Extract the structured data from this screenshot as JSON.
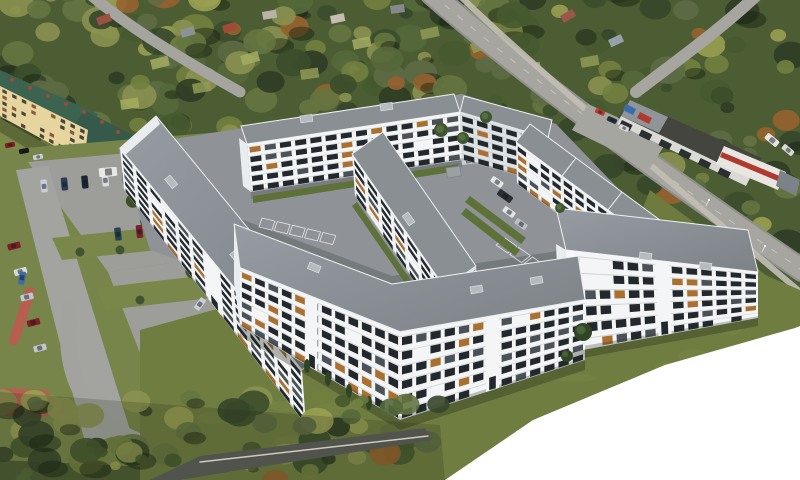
{
  "title": "Aerial 3D render of a new white residential apartment complex set into an aerial photograph",
  "visible_text": [],
  "colors": {
    "forest_base": "#4c5d33",
    "forest_palette": [
      "#3b4d2a",
      "#46592f",
      "#55683a",
      "#657540",
      "#72813f",
      "#5d6b44",
      "#8a9150",
      "#99a052",
      "#36462a",
      "#2e3c24"
    ],
    "forest_accent_rust": "#96622f",
    "lawn": "#6f7d40",
    "lawn_light": "#7b8a49",
    "left_grass": "#77854a",
    "road": "#a6a5a0",
    "road_edge": "#8f908c",
    "sidewalk": "#c2bfb4",
    "dark_road": "#51544c",
    "curb": "#cfcabd",
    "parking_asphalt": "#9d9e9a",
    "courtyard_asphalt": "#8f9398",
    "marking": "#ffffff",
    "facade": "#f3f5f6",
    "facade_shade": "#dde2e5",
    "gable": "#e9edef",
    "roof_gray": "#8a8f94",
    "roof_light": "#9aa0a6",
    "roof_dark": "#7e8388",
    "parapet": "#eef1f3",
    "window_dark": "#23282d",
    "window_light": "#4a5258",
    "wood_accent": "#a9702f",
    "green_roof": "#3c6350",
    "green_roof_dark": "#35594a",
    "yellow_facade": "#e7d5a0",
    "orange_facade": "#c8924e",
    "orange_roof": "#7a4434",
    "chimney_red": "#a14b36",
    "hedge": "#4d6330",
    "hedge_dark": "#3c5026",
    "tree_green": "#3f5531",
    "tree_dark": "#2f4526",
    "shed_roof": "#6b4a33",
    "red_path": "#b65f4e",
    "warehouse_roof": "#45453f",
    "warehouse_light": "#90959a",
    "retail_white": "#e8e6e0",
    "retail_red": "#b03a30",
    "sign_blue": "#3a6ea8",
    "container_gray": "#9aa0a4",
    "white_crop": "#ffffff",
    "shadow": "rgba(30,38,24,0.32)"
  },
  "scene": {
    "setting": "daytime aerial view, new housing estate render over photo background",
    "render_buildings": [
      {
        "id": "west-building",
        "floors": 6,
        "style": "long white slab, flat gray roof, balconies, wood accents"
      },
      {
        "id": "north-building",
        "floors": 5,
        "style": "long bent white slab at top of courtyard"
      },
      {
        "id": "center-building",
        "floors": 5,
        "style": "mid-block slab running toward viewer"
      },
      {
        "id": "east-buildings",
        "floors": 5,
        "blocks": 3,
        "style": "stepped row along the road"
      },
      {
        "id": "front-building",
        "floors": 6,
        "shape": "L",
        "style": "largest foreground building with corner"
      },
      {
        "id": "southeast-building",
        "floors": 6,
        "style": "detached slab on the lawn, white corner pilaster"
      }
    ],
    "photo_elements": [
      {
        "id": "existing-building",
        "roof": "green",
        "facade": "yellow",
        "chimneys": "red brick"
      },
      {
        "id": "orange-building",
        "position": "left edge"
      },
      {
        "id": "commercial-warehouse",
        "roof": "dark mottled"
      },
      {
        "id": "retail-building",
        "accent": "red stripe"
      },
      {
        "id": "allotment-gardens",
        "position": "top band"
      },
      {
        "id": "waste-shed",
        "roof": "brown"
      }
    ],
    "environment": {
      "tree_canopy": "dense mixed green/olive canopy across top and bottom-left",
      "main_road": "diagonal from top center to right edge",
      "parking": "two photo lots full of cars on the left, render stalls in courtyard",
      "lawn": "large olive lawn in front of render buildings",
      "white_corner": "render cut-off, pure white wedge at bottom right"
    }
  },
  "vehicles": {
    "car_colors": [
      "#7e1f26",
      "#1d2734",
      "#d9dbdd",
      "#151a1f",
      "#82222c",
      "#2a3d55",
      "#c8ced3",
      "#20262c",
      "#8f98a1",
      "#5f1e25",
      "#24424f",
      "#d3d5d6",
      "#31404e",
      "#101418",
      "#6e7780",
      "#7a2030",
      "#1a222c",
      "#c0c6cb",
      "#333a42",
      "#8c1f28"
    ],
    "van_color": "#e8e9e6",
    "approx_parked_cars_left": 38,
    "approx_cars_courtyard": 7
  }
}
